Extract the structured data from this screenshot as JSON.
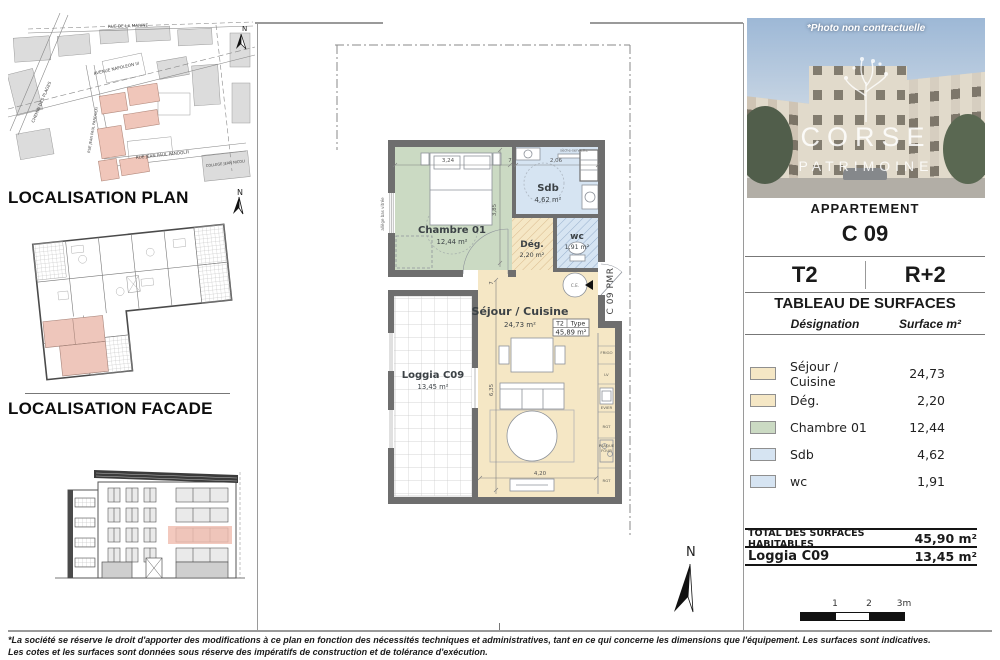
{
  "document": {
    "footer": {
      "line1": "*La société se réserve le droit d'apporter des modifications à ce plan en fonction des nécessités techniques et administratives, tant en ce qui concerne les dimensions que l'équipement. Les surfaces sont indicatives.",
      "line2": "Les cotes et les surfaces sont données sous réserve des impératifs de construction et de tolérance d'exécution."
    }
  },
  "left_column": {
    "plan_heading": "LOCALISATION PLAN",
    "facade_heading": "LOCALISATION FACADE",
    "north_label": "N",
    "map": {
      "streets": [
        "RUE DE LA MARINE",
        "AVENUE NAPOLEON III",
        "CHEMIN DES PLAGES",
        "RUE JEAN PAUL PANDOLFI",
        "RUE JEAN PAUL PANDOLFI",
        "COLLEGE JEAN NICOLI"
      ]
    }
  },
  "floor_plan": {
    "rooms": {
      "chambre": {
        "name": "Chambre 01",
        "area": "12,44 m²"
      },
      "sdb": {
        "name": "Sdb",
        "area": "4,62 m²"
      },
      "wc": {
        "name": "wc",
        "area": "1,91 m²"
      },
      "deg": {
        "name": "Dég.",
        "area": "2,20 m²"
      },
      "sejour": {
        "name": "Séjour / Cuisine",
        "area": "24,73 m²"
      },
      "loggia": {
        "name": "Loggia C09",
        "area": "13,45 m²"
      }
    },
    "type_box": {
      "type": "T2",
      "label": "Type",
      "area": "45,89 m²"
    },
    "entry_label": "C 09 PMR",
    "north_label": "N",
    "dimensions": {
      "top_a": "3,24",
      "top_b": "7",
      "top_c": "2,06",
      "chambre_h": "3,85",
      "wall": "7",
      "sejour_h": "6,35",
      "sejour_w": "4,20"
    },
    "kitchen_labels": [
      "FRIGO",
      "LV",
      "EVIER",
      "RGT",
      "PLAQUE",
      "FOUR",
      "RGT"
    ],
    "annotations": {
      "window": "allège bas vitrée",
      "towel": "sèche-serviette",
      "heater": "C.E."
    },
    "colors": {
      "sejour": "#f5e7c5",
      "chambre": "#cbdac3",
      "sdb": "#d6e4f2",
      "wall": "#6e6e6e",
      "highlight": "#f0c6ba"
    }
  },
  "right_panel": {
    "photo": {
      "caption": "*Photo non contractuelle",
      "brand_top": "CORSE",
      "brand_bottom": "PATRIMOINE"
    },
    "apartment_label": "APPARTEMENT",
    "apartment_code": "C 09",
    "unit_type": "T2",
    "floor": "R+2",
    "table_title": "TABLEAU DE SURFACES",
    "col_designation": "Désignation",
    "col_surface": "Surface m²",
    "rows": [
      {
        "label": "Séjour / Cuisine",
        "value": "24,73"
      },
      {
        "label": "Dég.",
        "value": "2,20"
      },
      {
        "label": "Chambre 01",
        "value": "12,44"
      },
      {
        "label": "Sdb",
        "value": "4,62"
      },
      {
        "label": "wc",
        "value": "1,91"
      }
    ],
    "total_label": "TOTAL DES SURFACES HABITABLES",
    "total_value": "45,90 m²",
    "loggia_label": "Loggia C09",
    "loggia_value": "13,45 m²",
    "scale_ticks": [
      "1",
      "2",
      "3m"
    ]
  }
}
